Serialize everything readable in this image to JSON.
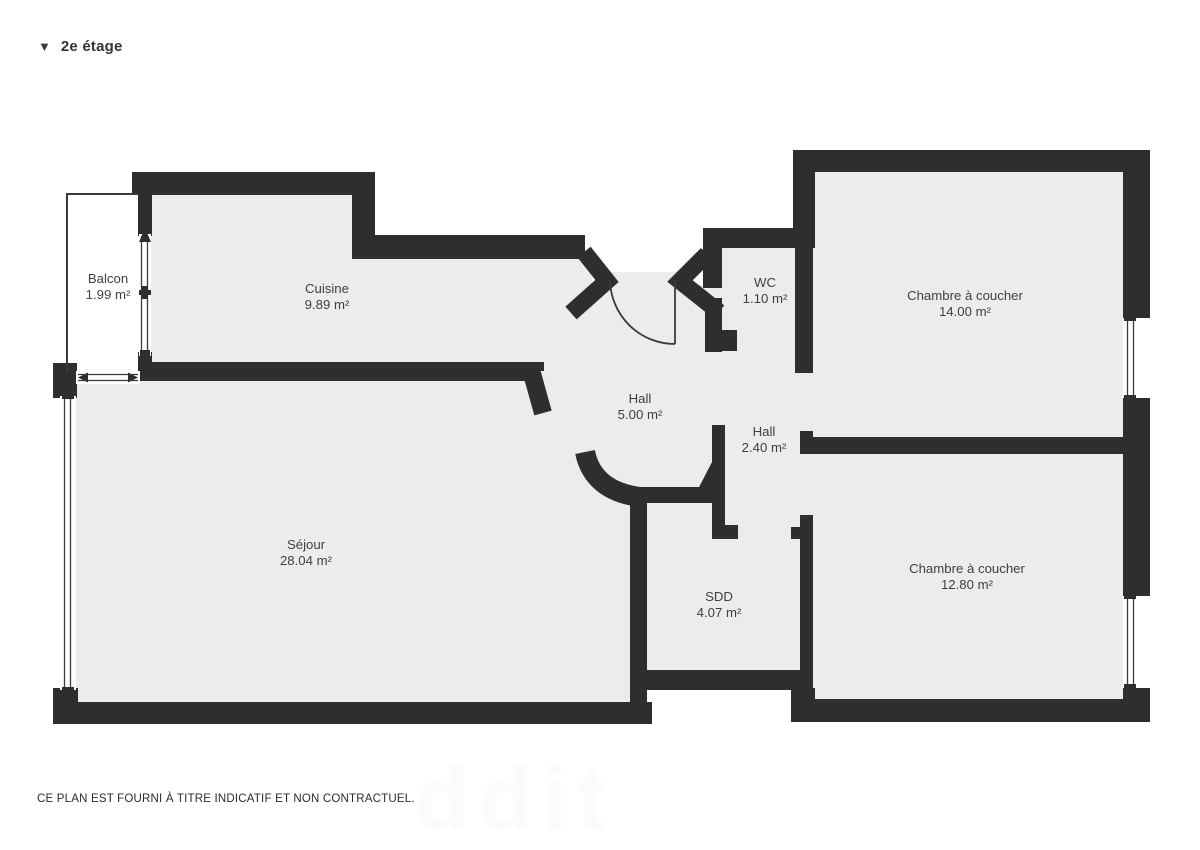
{
  "header": {
    "title": "2e étage",
    "collapse_icon": "triangle-down"
  },
  "rooms": [
    {
      "id": "balcon",
      "name": "Balcon",
      "area": "1.99 m²"
    },
    {
      "id": "cuisine",
      "name": "Cuisine",
      "area": "9.89 m²"
    },
    {
      "id": "wc",
      "name": "WC",
      "area": "1.10 m²"
    },
    {
      "id": "chambre-1",
      "name": "Chambre à coucher",
      "area": "14.00 m²"
    },
    {
      "id": "hall-1",
      "name": "Hall",
      "area": "5.00 m²"
    },
    {
      "id": "hall-2",
      "name": "Hall",
      "area": "2.40 m²"
    },
    {
      "id": "sejour",
      "name": "Séjour",
      "area": "28.04 m²"
    },
    {
      "id": "sdd",
      "name": "SDD",
      "area": "4.07 m²"
    },
    {
      "id": "chambre-2",
      "name": "Chambre à coucher",
      "area": "12.80 m²"
    }
  ],
  "footer": {
    "disclaimer": "CE PLAN EST FOURNI À TITRE INDICATIF ET NON CONTRACTUEL."
  },
  "watermark": "ddit",
  "colors": {
    "wall": "#2e2e2e",
    "floor": "#ececec",
    "label": "#3f3f3f",
    "background": "#ffffff"
  }
}
